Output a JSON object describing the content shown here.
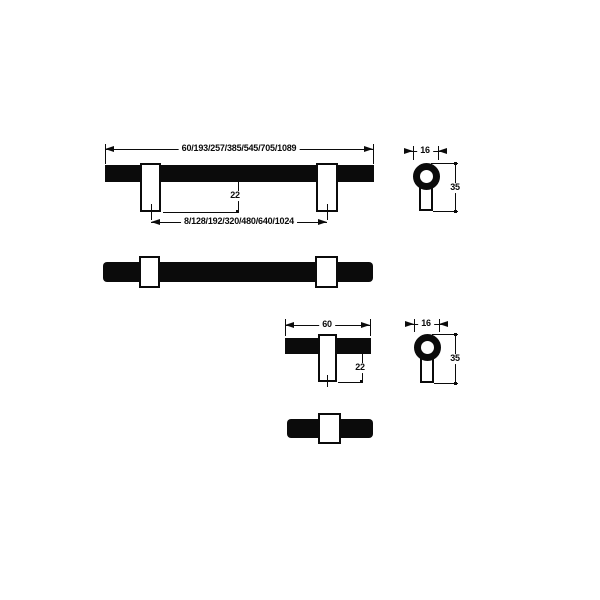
{
  "page": {
    "background": "#ffffff",
    "ink": "#0b0b0b",
    "description": "Technical dimension drawing of T-bar cabinet pulls and knob, front, plan and side views"
  },
  "views": {
    "pull_front": {
      "overall_length_label": "60/193/257/385/545/705/1089",
      "hole_centres_label": "8/128/192/320/480/640/1024",
      "projection_label": "22"
    },
    "pull_plan": {},
    "pull_side": {
      "diameter_label": "16",
      "depth_label": "35"
    },
    "knob_front": {
      "overall_length_label": "60",
      "projection_label": "22"
    },
    "knob_plan": {},
    "knob_side": {
      "diameter_label": "16",
      "depth_label": "35"
    }
  }
}
